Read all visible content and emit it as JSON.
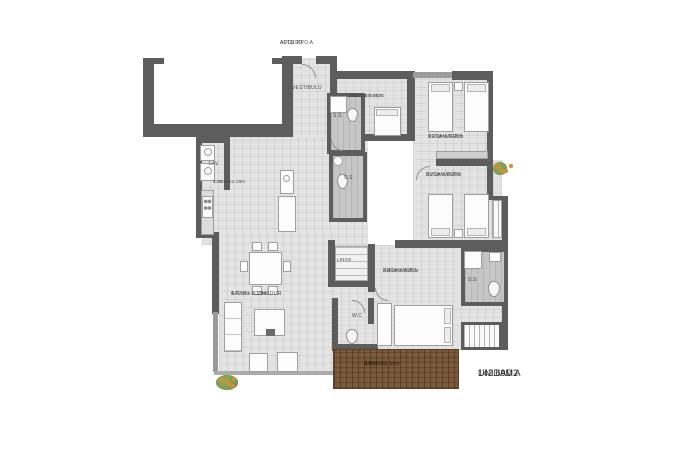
{
  "plan": {
    "access": {
      "line1": "ACCESO",
      "line2": "APTO TIPO A"
    },
    "unit": {
      "name": "UNIDAD A",
      "area": "142.69M2"
    },
    "rooms": {
      "vestibulo": {
        "name": "VESTIBULO"
      },
      "rec_servicio": {
        "name": "REC SERVICIO",
        "dims": "1.45m x 2.40m"
      },
      "recamara3": {
        "name": "RECAMARA 3",
        "dims": "3.70m x 3.28m"
      },
      "recamara2": {
        "name": "RECAMARA 2",
        "dims": "3.70m x 3.28m"
      },
      "recamara1": {
        "name": "RECAMARA 1",
        "dims": "3.40m x 3.36m"
      },
      "cocina": {
        "name": "COCINA",
        "dims": "1.70m x 2.29m"
      },
      "salon": {
        "name": "SALON - COMEDOR",
        "dims": "4.72m x 6.15m"
      },
      "balcon": {
        "name": "BALCON",
        "dims": "3.40m x 1.50m"
      },
      "lav": {
        "name": "LAV"
      },
      "linos": {
        "name": "LINOS"
      },
      "wc": {
        "name": "W.C"
      },
      "bath_upper": {
        "name": "S.S"
      },
      "bath_lower": {
        "name": "S.S"
      },
      "bath_rec1": {
        "name": "S.S"
      }
    },
    "colors": {
      "wall": "#5d5d5d",
      "wall-light": "#9b9b9b",
      "floor": "#e3e3e3",
      "floor-dark": "#c6c6c6",
      "furniture": "#fcfcfc",
      "furniture-border": "#9f9f9f",
      "deck": "#7a5a3b",
      "deck-line": "#594127",
      "plant-green": "#70914a",
      "plant-orange": "#d78e36",
      "label": "#4b4b4b",
      "title": "#2d2d2d"
    }
  }
}
